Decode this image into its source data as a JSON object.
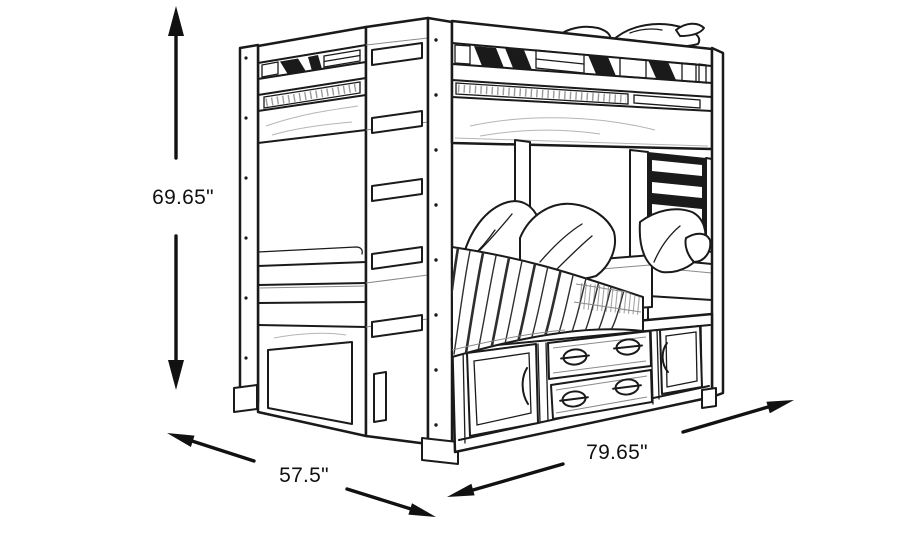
{
  "canvas": {
    "background": "#ffffff",
    "line_color": "#1a1a1a",
    "label_color": "#111111"
  },
  "diagram": {
    "type": "product-dimension-line-drawing",
    "subject_icon": "bunk-bed-with-storage-line-art",
    "dimensions": {
      "height": {
        "value": "69.65\"",
        "orientation": "vertical",
        "arrow_icon": "double-ended-vertical-arrow"
      },
      "depth": {
        "value": "57.5\"",
        "orientation": "diagonal-left",
        "arrow_icon": "double-ended-diagonal-arrow"
      },
      "length": {
        "value": "79.65\"",
        "orientation": "diagonal-right",
        "arrow_icon": "double-ended-diagonal-arrow"
      }
    }
  }
}
